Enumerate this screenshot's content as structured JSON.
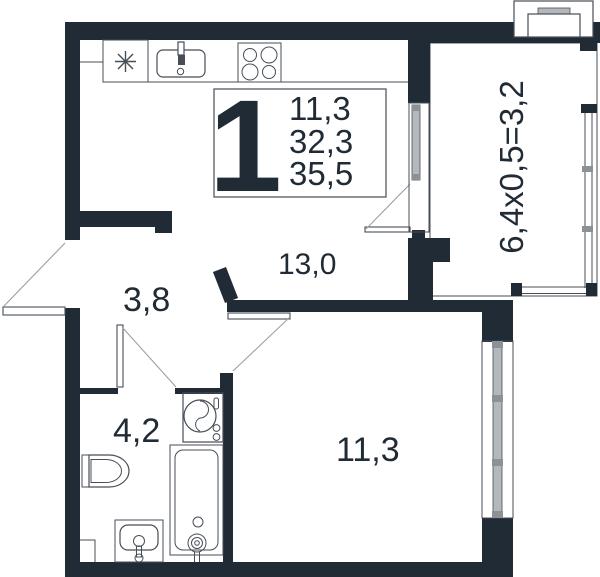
{
  "plan": {
    "title": "one-room apartment floor plan",
    "summary": {
      "rooms_count": "1",
      "line1": "11,3",
      "line2": "32,3",
      "line3": "35,5"
    },
    "labels": {
      "kitchen_living": "13,0",
      "hallway": "3,8",
      "bathroom": "4,2",
      "bedroom": "11,3",
      "balcony_formula": "6,4х0,5=3,2"
    },
    "icons": [
      "fridge-asterisk-icon",
      "kitchen-sink-icon",
      "stove-icon",
      "toilet-icon",
      "washing-machine-icon",
      "bathtub-icon",
      "basin-icon",
      "ac-unit-icon"
    ],
    "colors": {
      "wall": "#202b36",
      "line": "#474e56",
      "swing": "#9aa0a6",
      "glazing": "#b3b8bd",
      "glazingcap": "#8c9196",
      "bg": "#ffffff"
    }
  }
}
